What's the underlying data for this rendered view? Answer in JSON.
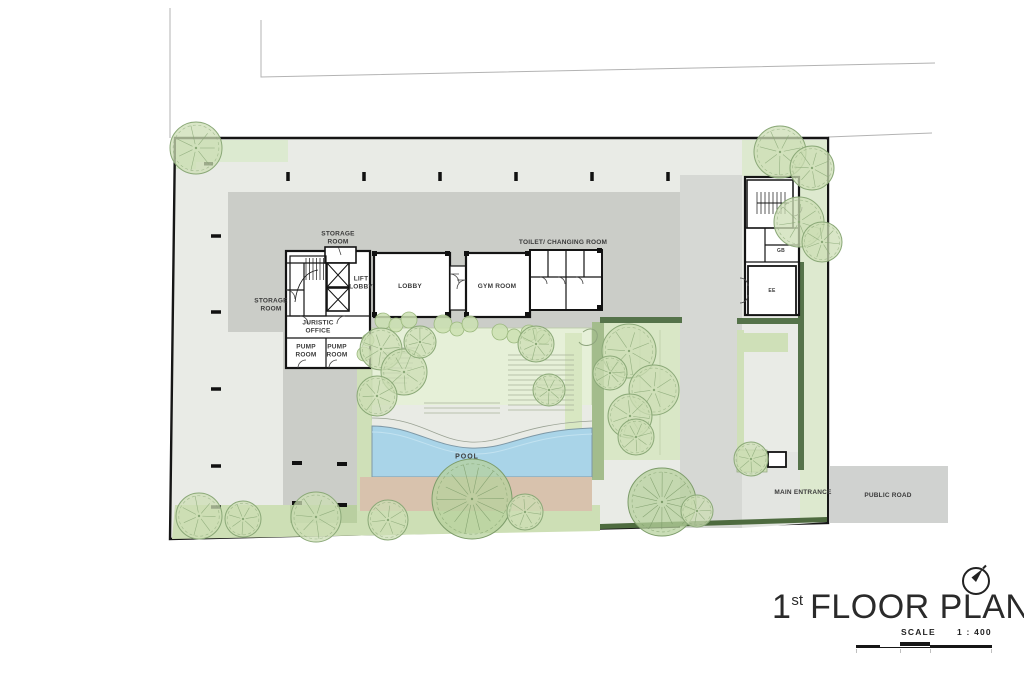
{
  "title": {
    "number": "1",
    "ordinal": "st",
    "text": "FLOOR PLAN"
  },
  "scale": {
    "label": "SCALE",
    "value": "1 : 400"
  },
  "labels": {
    "storage_room_top": "STORAGE ROOM",
    "storage_room_left": "STORAGE ROOM",
    "lift_lobby": "LIFT LOBBY",
    "lobby": "LOBBY",
    "gym_room": "GYM ROOM",
    "toilet_changing_room": "TOILET/ CHANGING ROOM",
    "juristic_office": "JURISTIC OFFICE",
    "pump_room_1": "PUMP ROOM",
    "pump_room_2": "PUMP ROOM",
    "gb": "GB",
    "ee": "EE",
    "pool": "POOL",
    "main_entrance": "MAIN ENTRANCE",
    "public_road": "PUBLIC ROAD"
  },
  "colors": {
    "site_fill": "#e9ebe6",
    "slab_fill": "#cbcdc8",
    "driveway_fill": "#d6d8d4",
    "lawn_fill": "#e6f0d8",
    "pool_fill": "#a9d4e8",
    "deck_fill": "#d8c2ad",
    "road_fill": "#d0d2d0",
    "light_green": "#dcead0",
    "band_green": "#a3bc8c",
    "hedge_green": "#55734a",
    "tree_fill": "#ccdeb4",
    "tree_stroke": "#8aa877",
    "tree_detailed_fill": "#b7d29e",
    "tree_detailed_stroke": "#7d9c6a",
    "bush_fill": "#cbe0b2",
    "bush_stroke": "#9cb97f",
    "wall_color": "#141414"
  },
  "trees": [
    {
      "x": 196,
      "y": 148,
      "r": 26
    },
    {
      "x": 780,
      "y": 152,
      "r": 26
    },
    {
      "x": 812,
      "y": 168,
      "r": 22
    },
    {
      "x": 799,
      "y": 222,
      "r": 25
    },
    {
      "x": 822,
      "y": 242,
      "r": 20
    },
    {
      "x": 381,
      "y": 349,
      "r": 21
    },
    {
      "x": 404,
      "y": 372,
      "r": 23
    },
    {
      "x": 377,
      "y": 396,
      "r": 20
    },
    {
      "x": 420,
      "y": 342,
      "r": 16
    },
    {
      "x": 536,
      "y": 344,
      "r": 18
    },
    {
      "x": 549,
      "y": 390,
      "r": 16
    },
    {
      "x": 629,
      "y": 351,
      "r": 27
    },
    {
      "x": 654,
      "y": 390,
      "r": 25
    },
    {
      "x": 630,
      "y": 416,
      "r": 22
    },
    {
      "x": 610,
      "y": 373,
      "r": 17
    },
    {
      "x": 636,
      "y": 437,
      "r": 18
    },
    {
      "x": 472,
      "y": 499,
      "r": 40,
      "d": true
    },
    {
      "x": 662,
      "y": 502,
      "r": 34,
      "d": true
    },
    {
      "x": 199,
      "y": 516,
      "r": 23
    },
    {
      "x": 243,
      "y": 519,
      "r": 18
    },
    {
      "x": 316,
      "y": 517,
      "r": 25
    },
    {
      "x": 388,
      "y": 520,
      "r": 20
    },
    {
      "x": 525,
      "y": 512,
      "r": 18
    },
    {
      "x": 697,
      "y": 511,
      "r": 16
    },
    {
      "x": 751,
      "y": 459,
      "r": 17
    }
  ],
  "bushes": [
    {
      "x": 383,
      "y": 321,
      "r": 8
    },
    {
      "x": 396,
      "y": 325,
      "r": 7
    },
    {
      "x": 409,
      "y": 320,
      "r": 8
    },
    {
      "x": 443,
      "y": 324,
      "r": 9
    },
    {
      "x": 457,
      "y": 329,
      "r": 7
    },
    {
      "x": 470,
      "y": 324,
      "r": 8
    },
    {
      "x": 500,
      "y": 332,
      "r": 8
    },
    {
      "x": 514,
      "y": 336,
      "r": 7
    },
    {
      "x": 529,
      "y": 333,
      "r": 8
    },
    {
      "x": 543,
      "y": 337,
      "r": 7
    },
    {
      "x": 368,
      "y": 340,
      "r": 6
    },
    {
      "x": 364,
      "y": 354,
      "r": 7
    }
  ],
  "column_ticks": {
    "top": {
      "y": 172,
      "xs": [
        288,
        364,
        440,
        516,
        592,
        668
      ]
    },
    "left": {
      "x": 211,
      "ys": [
        236,
        312,
        389,
        466,
        507
      ]
    },
    "parking": [
      [
        292,
        461
      ],
      [
        337,
        462
      ],
      [
        292,
        501
      ],
      [
        337,
        503
      ]
    ]
  }
}
